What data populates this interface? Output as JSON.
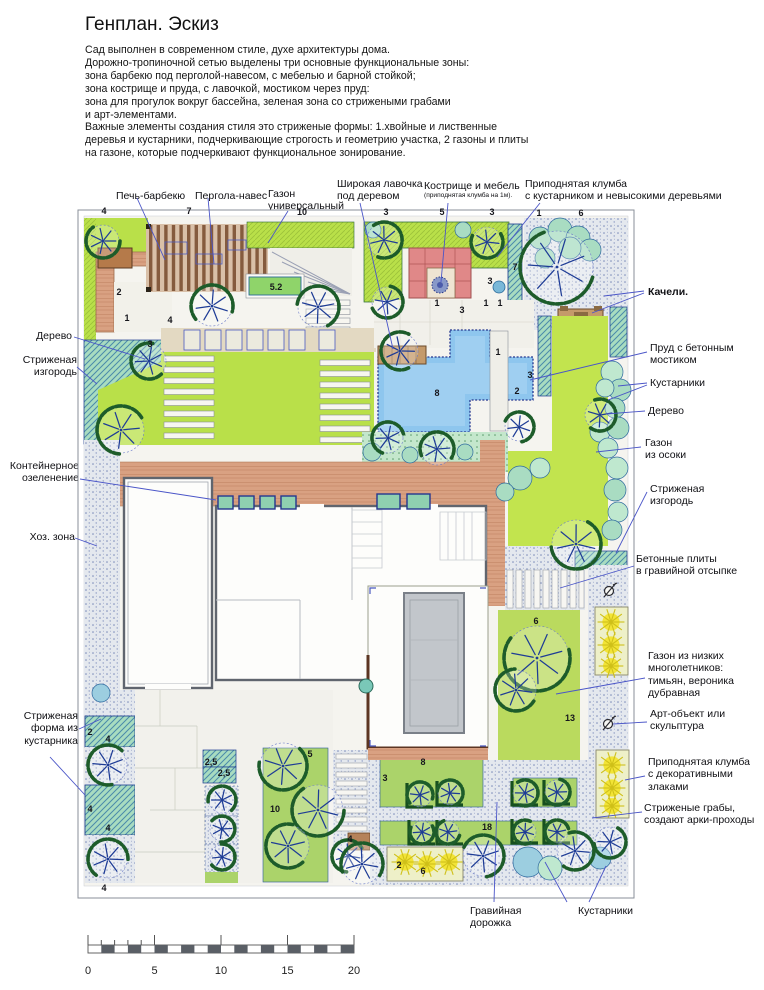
{
  "title": "Генплан. Эскиз",
  "description": [
    "Сад выполнен в современном стиле, духе архитектуры дома.",
    "Дорожно-тропиночной сетью выделены три основные функциональные зоны:",
    "зона барбекю под перголой-навесом, с мебелью и барной стойкой;",
    "зона кострище и пруда, с лавочкой, мостиком через пруд:",
    "зона для прогулок вокруг бассейна, зеленая зона со стрижеными грабами",
    "и арт-элементами.",
    "Важные элементы создания стиля это стриженые формы: 1.хвойные и лиственные",
    "деревья и кустарники, подчеркивающие строгость и геометрию участка, 2 газоны и плиты",
    "на газоне, которые подчеркивают функциональное зонирование."
  ],
  "labels": {
    "barbecue": [
      "Печь-барбекю"
    ],
    "pergola": [
      "Пергола-навес"
    ],
    "lawn_universal": [
      "Газон",
      "универсальный"
    ],
    "wide_bench": [
      "Широкая лавочка",
      "под деревом"
    ],
    "firepit": [
      "Кострище и мебель"
    ],
    "firepit_sub": [
      "(приподнятая клумба на 1м)."
    ],
    "raised_bed_top": [
      "Приподнятая клумба",
      "с кустарником и невысокими деревьями"
    ],
    "swing": [
      "Качели."
    ],
    "pond": [
      "Пруд с бетонным",
      "мостиком"
    ],
    "shrubs_right": [
      "Кустарники"
    ],
    "tree_right": [
      "Дерево"
    ],
    "sedge": [
      "Газон",
      "из осоки"
    ],
    "hedge_right": [
      "Стриженая",
      "изгородь"
    ],
    "plates": [
      "Бетонные плиты",
      "в гравийной отсыпке"
    ],
    "perennials": [
      "Газон из низких",
      "многолетников:",
      "тимьян, вероника",
      "дубравная"
    ],
    "art": [
      "Арт-объект или",
      "скульптура"
    ],
    "grass_bed": [
      "Приподнятая клумба",
      "с декоративными",
      "злаками"
    ],
    "hornbeams": [
      "Стриженые грабы,",
      "создают арки-проходы"
    ],
    "tree_left": [
      "Дерево"
    ],
    "hedge_left": [
      "Стриженая",
      "изгородь"
    ],
    "containers": [
      "Контейнерное",
      "озеленение"
    ],
    "hoz": [
      "Хоз. зона"
    ],
    "shrub_form": [
      "Стриженая",
      "форма из",
      "кустарника"
    ],
    "gravel_path": [
      "Гравийная",
      "дорожка"
    ],
    "shrubs_bottom": [
      "Кустарники"
    ]
  },
  "buildings": {
    "garage": "Гараж",
    "house": "Дом",
    "pool": "Бассейн"
  },
  "scalebar": {
    "ticks": [
      "0",
      "5",
      "10",
      "15",
      "20"
    ]
  },
  "colors": {
    "leader": "#4a55c8",
    "lawn": "#b9e049",
    "sedge_lawn": "#c2e44e",
    "bed_green": "#abd36a",
    "pond": "#8ec6ee",
    "terracotta": "#d9a182",
    "hedge_teal": "#a8dcc0",
    "gravel_dot": "#7a8ab8",
    "canopy": "#1d5c2a",
    "tree_line": "#1e3c96",
    "grass_yellow": "#f2e436",
    "firepit_pink": "#e08888",
    "pergola_slat": "#7a4e30",
    "pool_gray": "#c2c6cb"
  },
  "plan": {
    "numbers": [
      [
        104,
        214,
        "4"
      ],
      [
        189,
        214,
        "7"
      ],
      [
        302,
        215,
        "10"
      ],
      [
        386,
        215,
        "3"
      ],
      [
        442,
        215,
        "5"
      ],
      [
        492,
        215,
        "3"
      ],
      [
        539,
        216,
        "1"
      ],
      [
        581,
        216,
        "6"
      ],
      [
        276,
        290,
        "5.2"
      ],
      [
        515,
        270,
        "7"
      ],
      [
        490,
        284,
        "3"
      ],
      [
        119,
        295,
        "2"
      ],
      [
        127,
        321,
        "1"
      ],
      [
        170,
        323,
        "4"
      ],
      [
        150,
        347,
        "3"
      ],
      [
        437,
        306,
        "1"
      ],
      [
        462,
        313,
        "3"
      ],
      [
        486,
        306,
        "1"
      ],
      [
        500,
        306,
        "1"
      ],
      [
        437,
        396,
        "8"
      ],
      [
        498,
        355,
        "1"
      ],
      [
        530,
        378,
        "3"
      ],
      [
        517,
        394,
        "2"
      ],
      [
        536,
        624,
        "6"
      ],
      [
        570,
        721,
        "13"
      ],
      [
        211,
        765,
        "2,5"
      ],
      [
        224,
        776,
        "2,5"
      ],
      [
        310,
        757,
        "5"
      ],
      [
        275,
        812,
        "10"
      ],
      [
        423,
        765,
        "8"
      ],
      [
        385,
        781,
        "3"
      ],
      [
        487,
        830,
        "18"
      ],
      [
        350,
        842,
        "4"
      ],
      [
        399,
        868,
        "2"
      ],
      [
        423,
        874,
        "6"
      ],
      [
        90,
        735,
        "2"
      ],
      [
        108,
        742,
        "4"
      ],
      [
        90,
        812,
        "4"
      ],
      [
        108,
        831,
        "4"
      ],
      [
        104,
        891,
        "4"
      ]
    ],
    "trees": [
      [
        103,
        241,
        16
      ],
      [
        149,
        361,
        17
      ],
      [
        121,
        430,
        23
      ],
      [
        212,
        306,
        20
      ],
      [
        318,
        307,
        20
      ],
      [
        384,
        240,
        17
      ],
      [
        387,
        302,
        15
      ],
      [
        487,
        242,
        15
      ],
      [
        557,
        267,
        36
      ],
      [
        400,
        351,
        18
      ],
      [
        388,
        438,
        15
      ],
      [
        437,
        449,
        16
      ],
      [
        519,
        427,
        14
      ],
      [
        600,
        415,
        15
      ],
      [
        576,
        544,
        24
      ],
      [
        537,
        658,
        32
      ],
      [
        516,
        690,
        20
      ],
      [
        108,
        765,
        19
      ],
      [
        108,
        859,
        19
      ],
      [
        222,
        800,
        13
      ],
      [
        222,
        829,
        12
      ],
      [
        222,
        857,
        12
      ],
      [
        283,
        766,
        23
      ],
      [
        318,
        810,
        25
      ],
      [
        288,
        846,
        21
      ],
      [
        348,
        856,
        15
      ],
      [
        420,
        795,
        12
      ],
      [
        450,
        793,
        12
      ],
      [
        525,
        793,
        12
      ],
      [
        557,
        792,
        12
      ],
      [
        422,
        832,
        11
      ],
      [
        448,
        832,
        11
      ],
      [
        525,
        832,
        11
      ],
      [
        557,
        832,
        11
      ],
      [
        362,
        864,
        20
      ],
      [
        483,
        856,
        20
      ],
      [
        575,
        851,
        18
      ],
      [
        610,
        842,
        15
      ]
    ],
    "bushes": [
      [
        540,
        238,
        11,
        1
      ],
      [
        560,
        230,
        12,
        1
      ],
      [
        578,
        238,
        12,
        1
      ],
      [
        590,
        250,
        11,
        1
      ],
      [
        545,
        258,
        10,
        1
      ],
      [
        570,
        248,
        11,
        1
      ],
      [
        612,
        372,
        11,
        0
      ],
      [
        620,
        390,
        11,
        1
      ],
      [
        605,
        388,
        9,
        0
      ],
      [
        615,
        408,
        10,
        1
      ],
      [
        600,
        432,
        10,
        0
      ],
      [
        618,
        428,
        11,
        1
      ],
      [
        608,
        448,
        10,
        0
      ],
      [
        520,
        478,
        12,
        1
      ],
      [
        540,
        468,
        10,
        0
      ],
      [
        505,
        492,
        9,
        1
      ],
      [
        617,
        468,
        11,
        0
      ],
      [
        615,
        490,
        11,
        1
      ],
      [
        618,
        512,
        10,
        0
      ],
      [
        612,
        530,
        10,
        1
      ],
      [
        528,
        862,
        15,
        2
      ],
      [
        550,
        868,
        12,
        0
      ],
      [
        600,
        858,
        11,
        2
      ],
      [
        101,
        693,
        9,
        2
      ],
      [
        372,
        452,
        9,
        1
      ],
      [
        410,
        455,
        8,
        1
      ],
      [
        465,
        452,
        8,
        1
      ],
      [
        373,
        230,
        8,
        1
      ],
      [
        463,
        230,
        8,
        1
      ]
    ],
    "grasses": [
      [
        611,
        622,
        12
      ],
      [
        611,
        645,
        12
      ],
      [
        611,
        666,
        11
      ],
      [
        612,
        765,
        12
      ],
      [
        612,
        788,
        12
      ],
      [
        612,
        806,
        11
      ],
      [
        405,
        862,
        12
      ],
      [
        427,
        864,
        12
      ],
      [
        449,
        862,
        12
      ]
    ]
  }
}
